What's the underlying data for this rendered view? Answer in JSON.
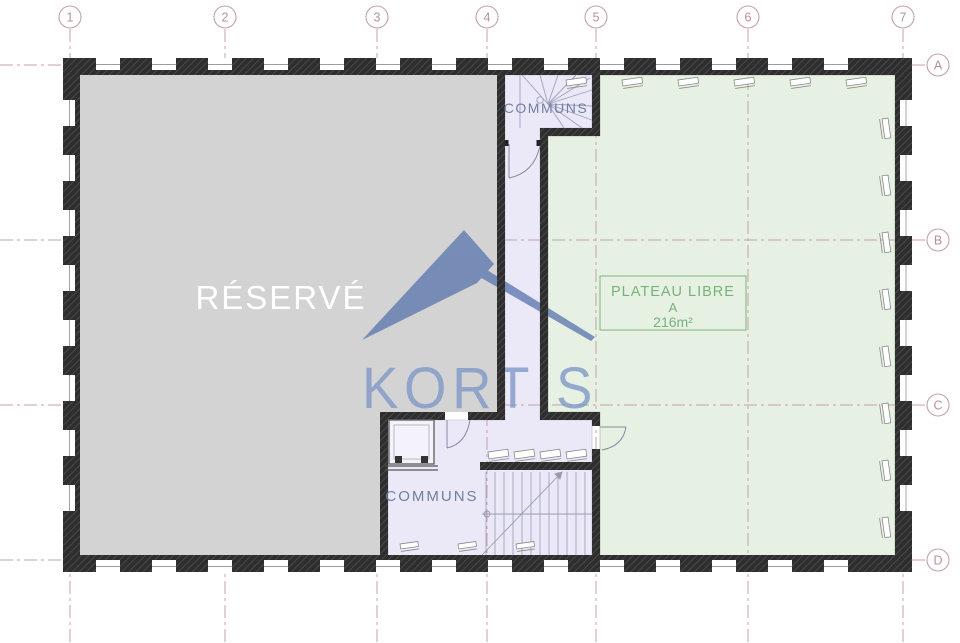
{
  "drawing": {
    "grid": {
      "columns": [
        "1",
        "2",
        "3",
        "4",
        "5",
        "6",
        "7"
      ],
      "rows": [
        "A",
        "B",
        "C",
        "D"
      ]
    },
    "rooms": {
      "reserve": {
        "label": "RÉSERVÉ"
      },
      "communs_top": {
        "label": "COMMUNS"
      },
      "communs_bottom": {
        "label": "COMMUNS"
      },
      "plateau_libre": {
        "name": "PLATEAU LIBRE",
        "unit": "A",
        "area": "216m²"
      }
    },
    "watermark": {
      "brand": "KORTIS"
    },
    "colors": {
      "reserved_fill": "#d3d3d3",
      "plateau_fill": "#e7f1e3",
      "plateau_edge": "#adc3ab",
      "communs_fill": "#ebe9f7",
      "communs_edge": "#b9b4d6",
      "grid_line": "#c79fa8",
      "grid_text": "#b9909a",
      "plateau_text": "#79b279",
      "room_text": "#6e80a4",
      "watermark_blue": "#5e78b0",
      "watermark_text": "#7e97c7"
    }
  }
}
